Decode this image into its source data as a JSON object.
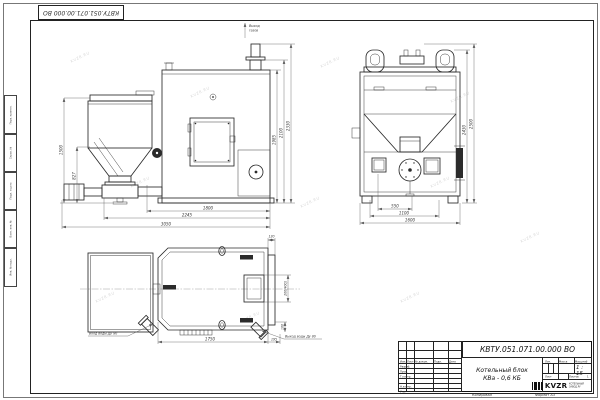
{
  "stamp": {
    "doc_number": "КВТУ.051.071.00.000 ВО"
  },
  "watermark": {
    "text": "KVZR.RU"
  },
  "margin": {
    "items": [
      "Перв. примен.",
      "Справ. №",
      "Подп. и дата",
      "Взам. инв. №",
      "Инв. № подл."
    ]
  },
  "views": {
    "front": {
      "gas_outlet_line1": "Выход",
      "gas_outlet_line2": "газов",
      "dims": {
        "h_hopper": "1500",
        "h_feeder": "827",
        "len_body": "1800",
        "len_mid": "2245",
        "len_total": "3050",
        "h_body": "1985",
        "h_mid": "2100",
        "h_total": "2330"
      }
    },
    "side": {
      "dims": {
        "w_center": "550",
        "w_mid": "1100",
        "w_total": "1600",
        "h_inner": "2430",
        "h_outer": "2500"
      }
    },
    "plan": {
      "inlet_label": "Вход воды Ду 80",
      "outlet_label": "Выход воды Ду 80",
      "dims": {
        "length": "1750",
        "offset": "195",
        "panel": "120",
        "door": "200(400)",
        "outlet_offset": "100"
      }
    }
  },
  "titleblock": {
    "doc_number": "КВТУ.051.071.00.000 ВО",
    "name_line1": "Котельный блок",
    "name_line2": "КВа - 0,6 КБ",
    "col_headers": {
      "izm": "Изм.",
      "list": "Лист",
      "doc": "№ докум.",
      "sign": "Подп.",
      "date": "Дата"
    },
    "rows": [
      "Разраб.",
      "Пров.",
      "Т.контр.",
      "",
      "Н.контр.",
      "Утв."
    ],
    "lit_header": "Лит.",
    "mass_header": "Масса",
    "scale_header": "Масштаб",
    "scale_value": "1 : 15",
    "sheet_label": "Лист",
    "sheets_label": "Листов",
    "sheets_value": "1",
    "company": {
      "logo_text": "KVZR",
      "sub1": "КОТЕЛЬНЫЙ",
      "sub2": "ЗАВОД.РУ"
    },
    "footer": {
      "copied": "Копировал",
      "format": "Формат А3"
    }
  }
}
